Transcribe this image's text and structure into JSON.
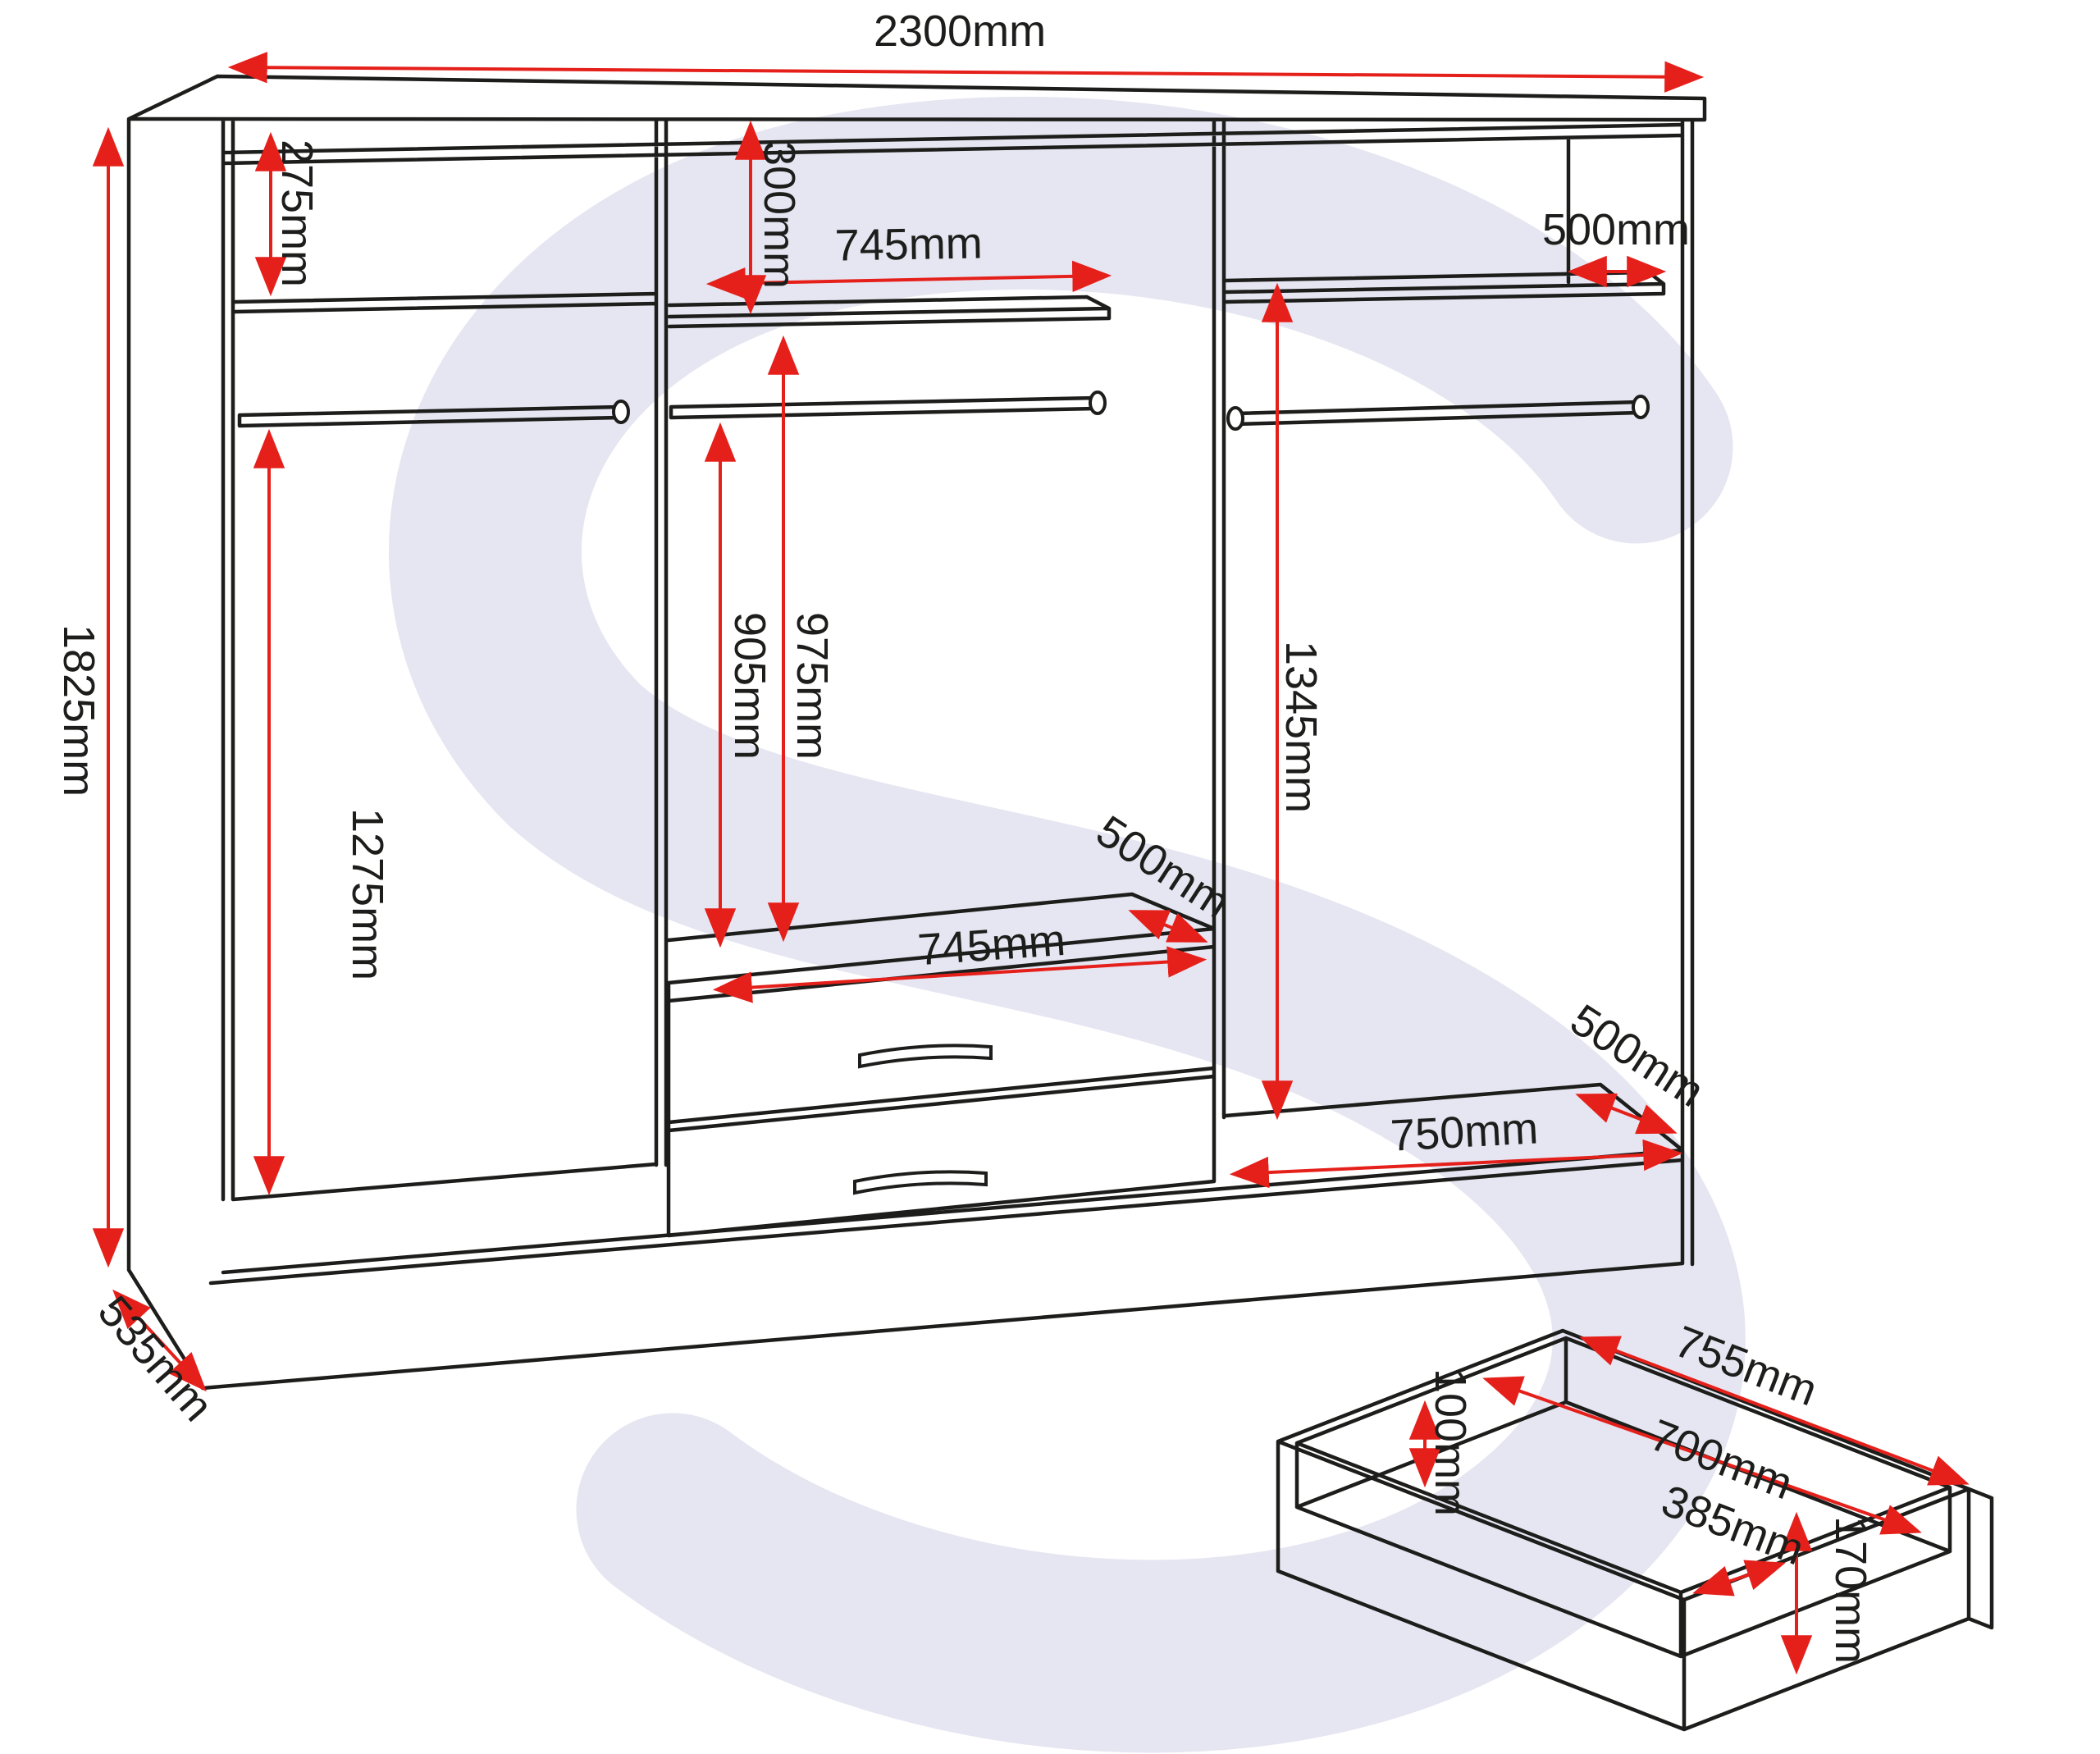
{
  "colors": {
    "line": "#1d1d1b",
    "dimension_red": "#e5201b",
    "watermark": "#e6e6f2",
    "background": "#ffffff"
  },
  "watermark_letter": "S",
  "dims": {
    "overall_width": "2300mm",
    "overall_height": "1825mm",
    "side_depth": "535mm",
    "left_top_shelf_height": "275mm",
    "left_hanging_height": "1275mm",
    "mid_top_shelf_height": "300mm",
    "mid_shelf_width": "745mm",
    "mid_rail_to_drawers": "905mm",
    "mid_shelf_to_drawers": "975mm",
    "mid_shelf_depth": "500mm",
    "mid_drawer_width": "745mm",
    "right_hanging_height": "1345mm",
    "right_shelf_depth": "500mm",
    "right_base_depth": "500mm",
    "right_base_width": "750mm",
    "box_outer_length": "755mm",
    "box_inner_length": "700mm",
    "box_inner_width": "385mm",
    "box_side_height": "100mm",
    "box_front_height": "170mm"
  }
}
